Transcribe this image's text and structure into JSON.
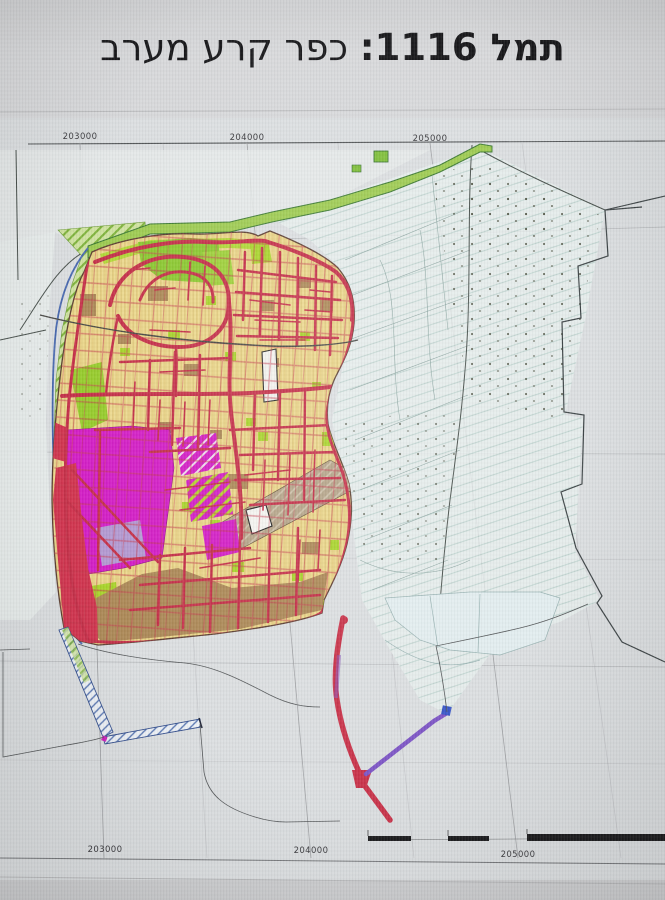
{
  "title": {
    "plan_id": "תמל 1116:",
    "plan_name": "כפר קרע מערב"
  },
  "grid": {
    "top": [
      "203000",
      "204000",
      "205000"
    ],
    "bottom": [
      "203000",
      "204000",
      "205000"
    ]
  },
  "colors": {
    "residential_yellow": "#ecd88e",
    "road_red": "#c5314a",
    "public_green": "#8cc831",
    "lime_green": "#a9d42c",
    "commercial_magenta": "#d31fc6",
    "employment_brown": "#ad8a58",
    "road_purple": "#7e57c6",
    "red_zone": "#d23550",
    "lavender_zone": "#b49ad2",
    "agri_tint": "#e9f0ef",
    "sheet_gray": "#dcdfe1"
  }
}
